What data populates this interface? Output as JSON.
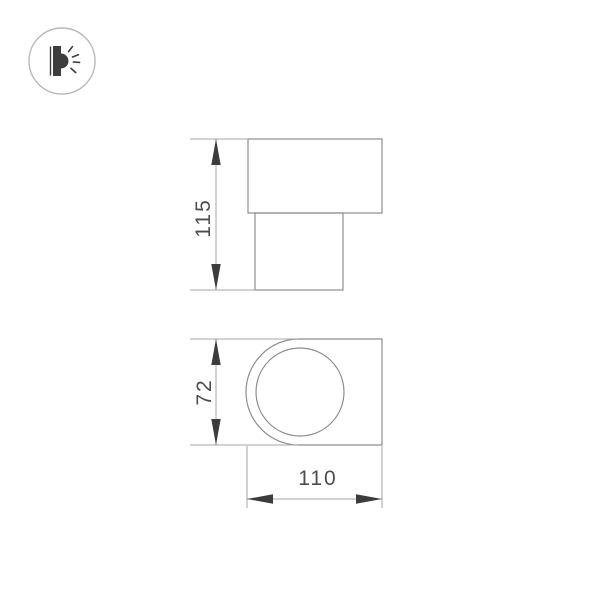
{
  "canvas": {
    "width": 600,
    "height": 600,
    "background": "#ffffff"
  },
  "logo": {
    "icon": "wall-lamp-emitting-light",
    "ring_color": "#b9b9b9",
    "glyph_color": "#3d3d3d",
    "fill": "#ffffff"
  },
  "drawing": {
    "type": "technical-dimension-diagram",
    "dimensions": {
      "side_height": "115",
      "front_height": "72",
      "front_width": "110"
    }
  },
  "colors": {
    "outline": "#8e8e8e",
    "dimension_line": "#a6a6a6",
    "arrow": "#3c3c3c",
    "text": "#4d4d4d"
  }
}
